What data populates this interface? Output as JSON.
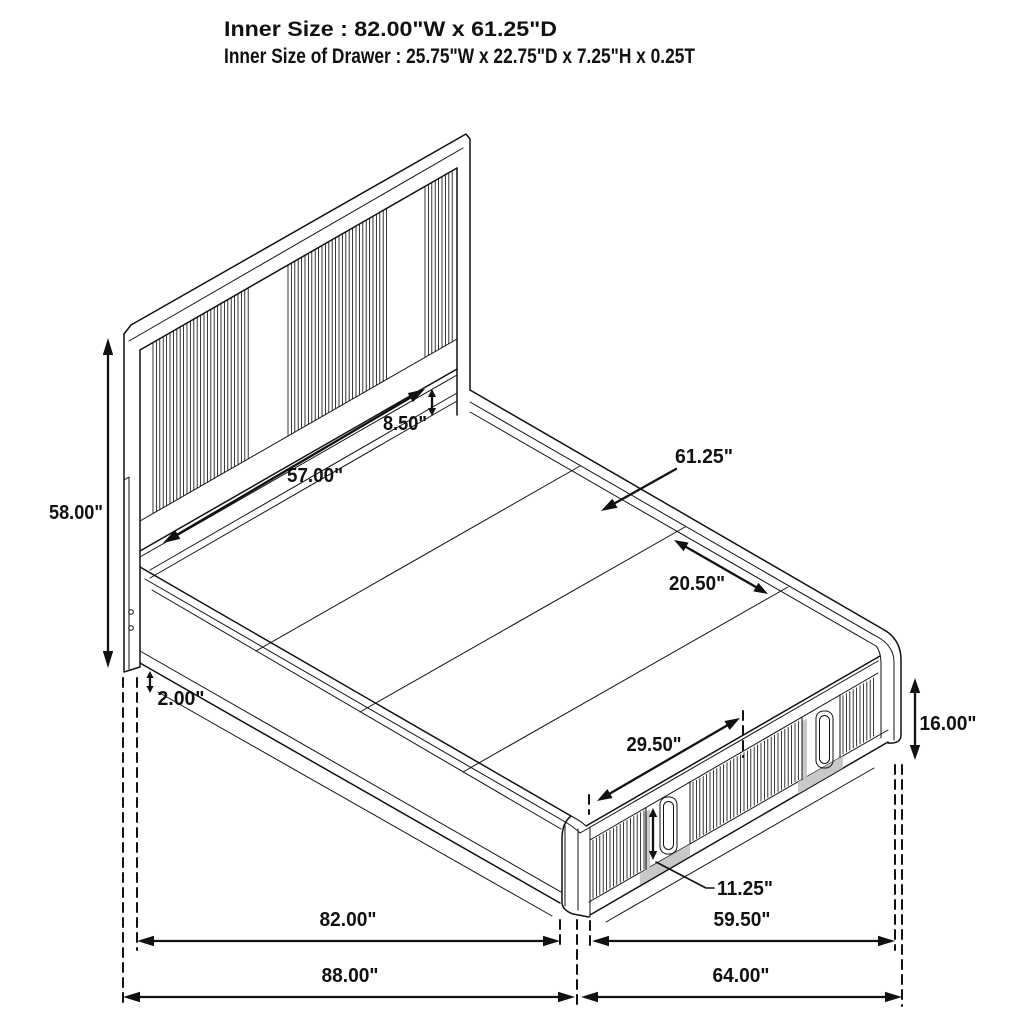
{
  "header": {
    "line1": "Inner Size : 82.00\"W x 61.25\"D",
    "line2": "Inner Size of Drawer : 25.75\"W x 22.75\"D x 7.25\"H x 0.25T"
  },
  "dimensions": {
    "headboard_height": "58.00\"",
    "headboard_width": "57.00\"",
    "headboard_to_deck_gap": "8.50\"",
    "deck_depth": "61.25\"",
    "deck_plank_span": "20.50\"",
    "base_reveal": "2.00\"",
    "platform_height": "16.00\"",
    "drawer_front_width": "29.50\"",
    "drawer_handle_height": "11.25\"",
    "inner_length": "82.00\"",
    "inner_width": "59.50\"",
    "outer_length": "88.00\"",
    "outer_width": "64.00\""
  },
  "colors": {
    "line": "#111111",
    "background": "#ffffff",
    "shadow": "#c8c8c8"
  }
}
